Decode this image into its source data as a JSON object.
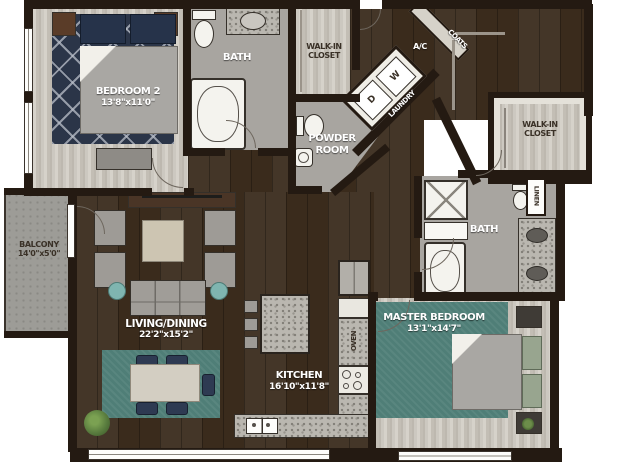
{
  "plan_title": "apartment floor plan",
  "rooms": {
    "bedroom2": {
      "name": "BEDROOM 2",
      "dims": "13'8\"x11'0\""
    },
    "bath1": {
      "name": "BATH"
    },
    "walkin_closet_1": {
      "line1": "WALK-IN",
      "line2": "CLOSET"
    },
    "coats": {
      "name": "COATS"
    },
    "ac": {
      "name": "A/C"
    },
    "laundry": {
      "name": "LAUNDRY",
      "dryer": "D",
      "washer": "W"
    },
    "powder": {
      "line1": "POWDER",
      "line2": "ROOM"
    },
    "walkin_closet_2": {
      "line1": "WALK-IN",
      "line2": "CLOSET"
    },
    "linen": {
      "name": "LINEN"
    },
    "bath2": {
      "name": "BATH"
    },
    "master": {
      "name": "MASTER BEDROOM",
      "dims": "13'1\"x14'7\""
    },
    "kitchen": {
      "name": "KITCHEN",
      "dims": "16'10\"x11'8\""
    },
    "living": {
      "name": "LIVING/DINING",
      "dims": "22'2\"x15'2\""
    },
    "balcony": {
      "name": "BALCONY",
      "dims": "14'0\"x5'0\""
    },
    "oven": {
      "name": "OVEN"
    }
  },
  "colors": {
    "wall": "#241a12",
    "dark_wood_floor": "#3a2b1c",
    "light_wood_floor": "#c9c5bd",
    "bath_tile": "#a8a5a0",
    "granite": "#bab7b0",
    "teal_rug": "#4f7e77",
    "navy_rug": "#2b3548",
    "sage_pillow": "#98a58f",
    "plant_green": "#5a7d3f"
  }
}
